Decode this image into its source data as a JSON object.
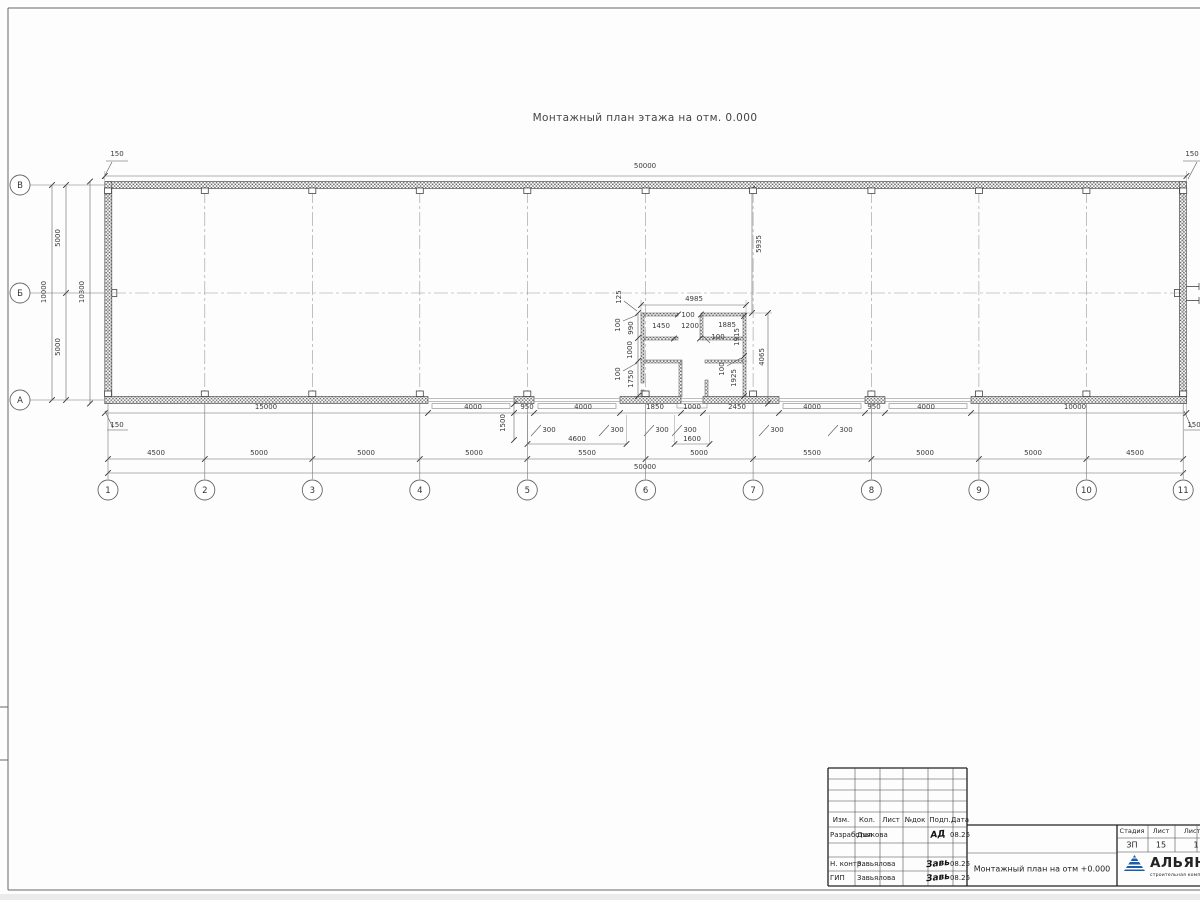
{
  "page": {
    "drawing_title": "Монтажный план этажа на отм. 0.000"
  },
  "plan": {
    "axes_cols": [
      {
        "label": "1",
        "x": 108
      },
      {
        "label": "2",
        "x": 204.8
      },
      {
        "label": "3",
        "x": 312.3
      },
      {
        "label": "4",
        "x": 419.8
      },
      {
        "label": "5",
        "x": 527.3
      },
      {
        "label": "6",
        "x": 645.6
      },
      {
        "label": "7",
        "x": 753.1
      },
      {
        "label": "8",
        "x": 871.4
      },
      {
        "label": "9",
        "x": 978.9
      },
      {
        "label": "10",
        "x": 1086.4
      },
      {
        "label": "11",
        "x": 1183.2
      }
    ],
    "axes_rows": [
      {
        "label": "В",
        "y": 185,
        "dash": false
      },
      {
        "label": "Б",
        "y": 293,
        "dash": true
      },
      {
        "label": "А",
        "y": 400,
        "dash": false
      }
    ],
    "dim_labels": [
      {
        "t": "150",
        "x": 117,
        "y": 156
      },
      {
        "t": "50000",
        "x": 645,
        "y": 168
      },
      {
        "t": "150",
        "x": 1192,
        "y": 156
      },
      {
        "t": "10000",
        "x": 46,
        "y": 292,
        "r": 1
      },
      {
        "t": "5000",
        "x": 60,
        "y": 238,
        "r": 1
      },
      {
        "t": "5000",
        "x": 60,
        "y": 347,
        "r": 1
      },
      {
        "t": "10300",
        "x": 84,
        "y": 292,
        "r": 1
      },
      {
        "t": "5935",
        "x": 761,
        "y": 244,
        "r": 1
      },
      {
        "t": "125",
        "x": 621,
        "y": 297,
        "r": 1
      },
      {
        "t": "4985",
        "x": 694,
        "y": 301
      },
      {
        "t": "100",
        "x": 688,
        "y": 317
      },
      {
        "t": "1450",
        "x": 661,
        "y": 328
      },
      {
        "t": "1200",
        "x": 690,
        "y": 328
      },
      {
        "t": "1885",
        "x": 727,
        "y": 327
      },
      {
        "t": "100",
        "x": 718,
        "y": 339
      },
      {
        "t": "100",
        "x": 620,
        "y": 325,
        "r": 1
      },
      {
        "t": "990",
        "x": 633,
        "y": 328,
        "r": 1
      },
      {
        "t": "1000",
        "x": 632,
        "y": 350,
        "r": 1
      },
      {
        "t": "100",
        "x": 620,
        "y": 374,
        "r": 1
      },
      {
        "t": "1750",
        "x": 633,
        "y": 379,
        "r": 1
      },
      {
        "t": "1915",
        "x": 739,
        "y": 337,
        "r": 1
      },
      {
        "t": "100",
        "x": 724,
        "y": 369,
        "r": 1
      },
      {
        "t": "1925",
        "x": 736,
        "y": 378,
        "r": 1
      },
      {
        "t": "4065",
        "x": 764,
        "y": 357,
        "r": 1
      },
      {
        "t": "15000",
        "x": 266,
        "y": 409
      },
      {
        "t": "4000",
        "x": 473,
        "y": 409
      },
      {
        "t": "950",
        "x": 527,
        "y": 409
      },
      {
        "t": "4000",
        "x": 583,
        "y": 409
      },
      {
        "t": "1850",
        "x": 655,
        "y": 409
      },
      {
        "t": "1000",
        "x": 692,
        "y": 409
      },
      {
        "t": "2450",
        "x": 737,
        "y": 409
      },
      {
        "t": "4000",
        "x": 812,
        "y": 409
      },
      {
        "t": "950",
        "x": 874,
        "y": 409
      },
      {
        "t": "4000",
        "x": 926,
        "y": 409
      },
      {
        "t": "10000",
        "x": 1075,
        "y": 409
      },
      {
        "t": "150",
        "x": 117,
        "y": 427
      },
      {
        "t": "150",
        "x": 1194,
        "y": 427
      },
      {
        "t": "1500",
        "x": 505,
        "y": 423,
        "r": 1
      },
      {
        "t": "300",
        "x": 549,
        "y": 432
      },
      {
        "t": "300",
        "x": 617,
        "y": 432
      },
      {
        "t": "300",
        "x": 662,
        "y": 432
      },
      {
        "t": "300",
        "x": 690,
        "y": 432
      },
      {
        "t": "300",
        "x": 777,
        "y": 432
      },
      {
        "t": "300",
        "x": 846,
        "y": 432
      },
      {
        "t": "4600",
        "x": 577,
        "y": 441
      },
      {
        "t": "1600",
        "x": 692,
        "y": 441
      },
      {
        "t": "4500",
        "x": 156,
        "y": 455
      },
      {
        "t": "5000",
        "x": 259,
        "y": 455
      },
      {
        "t": "5000",
        "x": 366,
        "y": 455
      },
      {
        "t": "5000",
        "x": 474,
        "y": 455
      },
      {
        "t": "5500",
        "x": 587,
        "y": 455
      },
      {
        "t": "5000",
        "x": 699,
        "y": 455
      },
      {
        "t": "5500",
        "x": 812,
        "y": 455
      },
      {
        "t": "5000",
        "x": 925,
        "y": 455
      },
      {
        "t": "5000",
        "x": 1033,
        "y": 455
      },
      {
        "t": "4500",
        "x": 1135,
        "y": 455
      },
      {
        "t": "50000",
        "x": 645,
        "y": 469
      }
    ]
  },
  "titleblock": {
    "col_izm": "Изм.",
    "col_kol": "Кол.",
    "col_list": "Лист",
    "col_ndok": "№док",
    "col_podp": "Подп.",
    "col_data": "Дата",
    "r1_role": "Разработал",
    "r1_name": "Дьякова",
    "r1_sig": "АД",
    "r1_date": "08.25",
    "r2_role": "Н. контр.",
    "r2_name": "Завьялова",
    "r2_sig": "Завь",
    "r2_date": "08.25",
    "r3_role": "ГИП",
    "r3_name": "Завьялова",
    "r3_sig": "Завь",
    "r3_date": "08.25",
    "doc_title": "Монтажный план на отм +0.000",
    "stage_label": "Стадия",
    "sheet_label": "Лист",
    "sheets_label": "Листов",
    "stage_value": "ЗП",
    "sheet_value": "15",
    "sheets_value": "1",
    "logo_name": "АЛЬЯНС",
    "logo_sub": "строительная компания",
    "logo_color": "#1a5dab"
  }
}
